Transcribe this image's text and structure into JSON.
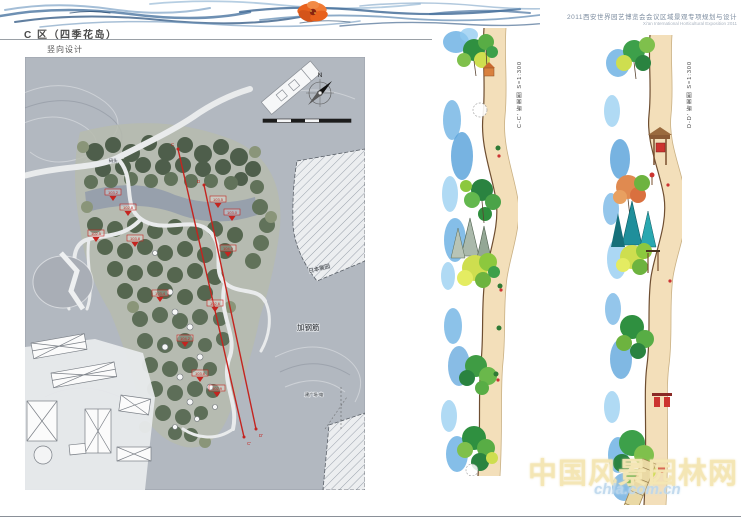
{
  "header": {
    "zone_title": "C 区（四季花岛）",
    "subtitle": "竖向设计"
  },
  "project": {
    "title_cn": "2011西安世界园艺博览会会议区域景观专项规划与设计",
    "title_en": "Xi'an International Horticultural Exposition 2011"
  },
  "map": {
    "north_label": "N",
    "labels": {
      "dock": "码头",
      "japan_garden": "日本展园",
      "note_rebar": "加钢筋",
      "note_plaza": "建广场·电"
    },
    "section_line_ends": {
      "c_start": "C",
      "c_end": "C'",
      "d_start": "D",
      "d_end": "D'"
    },
    "markers": [
      {
        "value": "103.2"
      },
      {
        "value": "102.8"
      },
      {
        "value": "103.5"
      },
      {
        "value": "103.0"
      },
      {
        "value": "102.5"
      },
      {
        "value": "103.8"
      },
      {
        "value": "104.0"
      },
      {
        "value": "103.4"
      },
      {
        "value": "102.6"
      },
      {
        "value": "104.2"
      },
      {
        "value": "103.6"
      },
      {
        "value": "102.9"
      }
    ]
  },
  "sections": {
    "c_label": "C-C' 断面图 S=1:300",
    "d_label": "D-D' 断面图 S=1:300"
  },
  "watermark": {
    "site_name": "中国风景园林网",
    "site_url": "chla.com.cn"
  }
}
